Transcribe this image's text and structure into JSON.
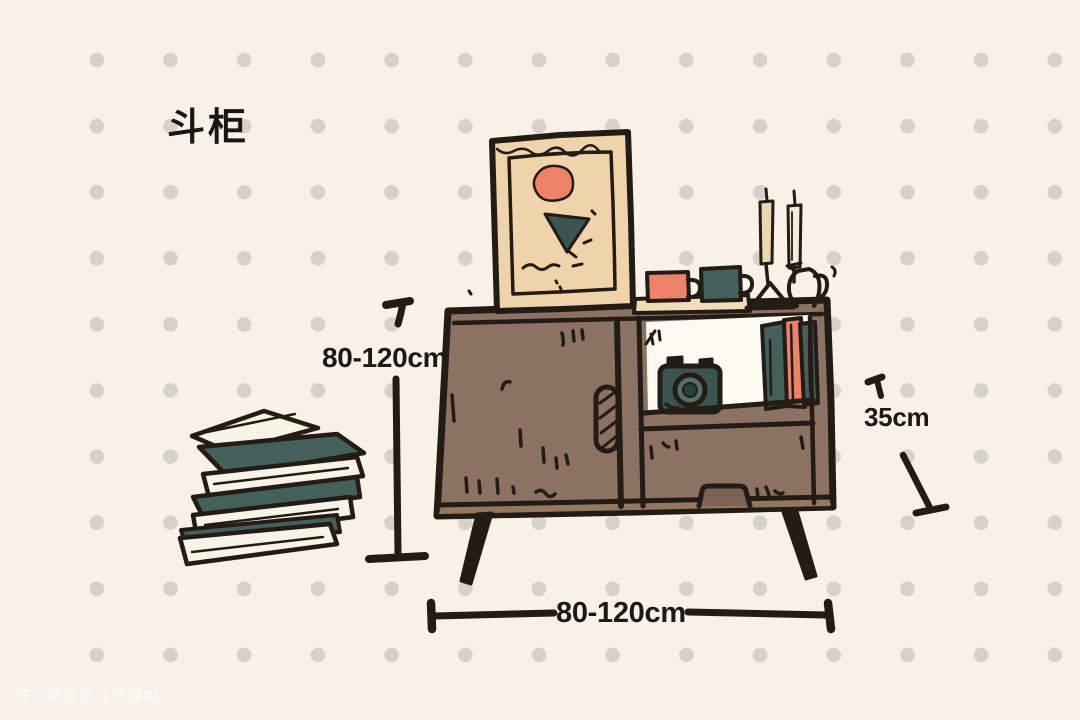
{
  "page": {
    "title": "斗柜",
    "watermark": "住小帮@设计师猫姐"
  },
  "dimensions": {
    "height_label": "80-120cm",
    "width_label": "80-120cm",
    "depth_label": "35cm"
  },
  "illustration": {
    "scene": "hand-drawn sideboard (chest cabinet) with decor",
    "elements": [
      "picture-frame",
      "abstract-blob",
      "abstract-triangle",
      "coral-mug",
      "teal-mug",
      "serving-tray",
      "two-candlesticks",
      "outlined-jug",
      "sideboard-cabinet",
      "sliding-door",
      "hatched-door-handle",
      "open-shelf",
      "camera",
      "shelf-books",
      "drawer",
      "drawer-handle",
      "tapered-legs",
      "floor-book-stack"
    ]
  },
  "colors": {
    "background": "#f7f1e8",
    "dots": "#d6d1c9",
    "ink": "#221c15",
    "cabinet_brown": "#8b7263",
    "cabinet_base": "#93785f",
    "drawer_recess": "#7a6352",
    "frame_tan": "#eed3ab",
    "tray_tan": "#f0ddb8",
    "candle_tan": "#ead6b2",
    "candle_light": "#f3ecdf",
    "coral": "#ec8267",
    "teal": "#44605b",
    "teal_dark": "#3a554f",
    "teal_deep": "#26403c",
    "lens_ring": "#54706a",
    "shelf_white": "#fdfaf2",
    "book_cream": "#f8f3e7"
  }
}
